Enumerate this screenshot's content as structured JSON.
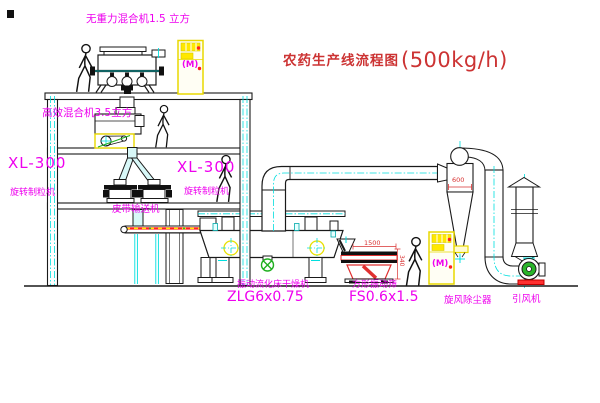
{
  "title": {
    "text": "农药生产线流程图",
    "capacity": "(500kg/h)"
  },
  "equipment_labels": {
    "mixer_top": "无重力混合机1.5 立方",
    "mixer_second": "高效混合机3.5立方",
    "granulator_left_model": "XL-300",
    "granulator_left_name": "旋转制粒机",
    "granulator_right_model": "XL-300",
    "granulator_right_name": "旋转制粒机",
    "belt_conveyor": "皮带输送机",
    "fluid_bed_dryer_name": "振动流化床干燥机",
    "fluid_bed_dryer_model": "ZLG6x0.75",
    "square_sieve_name": "方形振动筛",
    "square_sieve_model": "FS0.6x1.5",
    "cyclone_dust_collector": "旋风除尘器",
    "induced_draft_fan": "引风机"
  },
  "annotations": {
    "cyclone_diameter": "600",
    "sieve_length": "1500",
    "sieve_height": "340",
    "cabinet_top_motor": "(M)",
    "cabinet_right_motor": "(M)"
  },
  "colors": {
    "label_magenta": "#ee00ee",
    "title_red": "#cc3333",
    "dimension_red": "#d83030",
    "machine_red": "#ff2020",
    "centerline_cyan": "#00dede",
    "cabinet_yellow": "#ffe800",
    "valve_green": "#1faf1f",
    "line_black": "#1a1a1a"
  }
}
